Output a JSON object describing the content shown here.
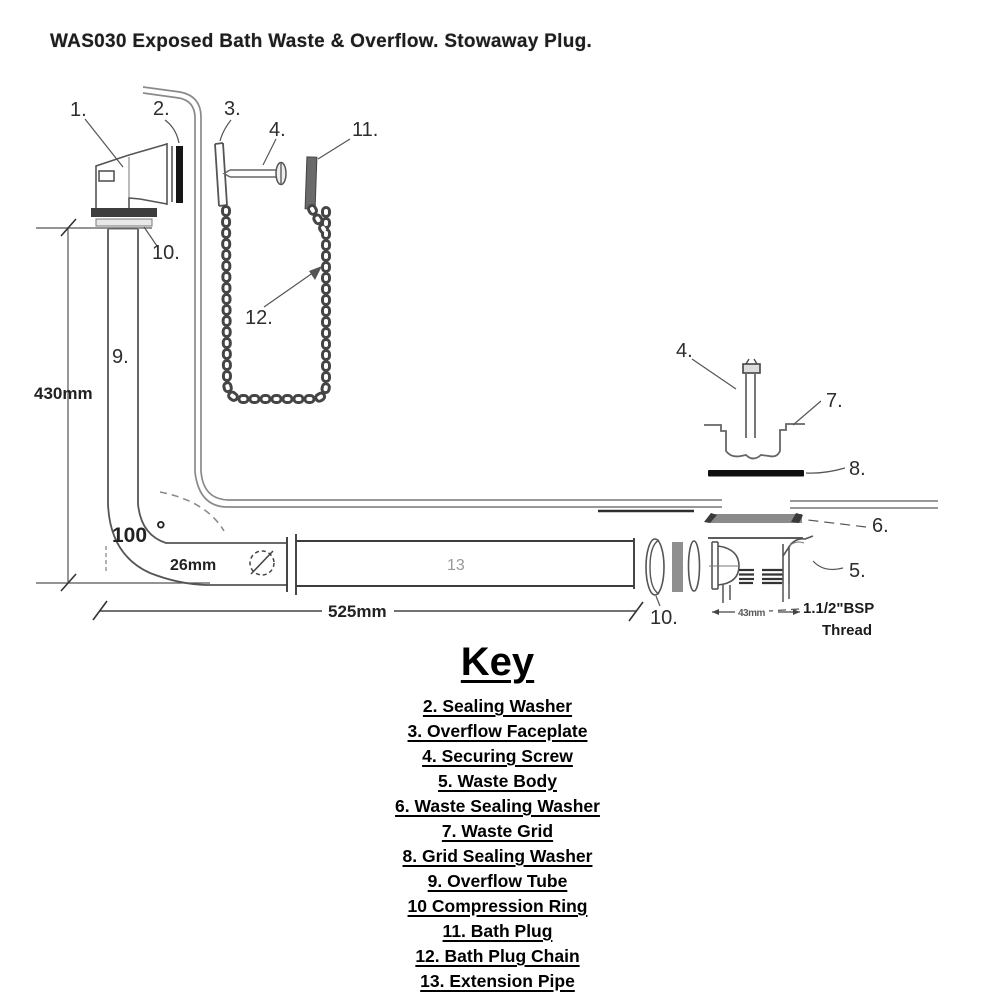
{
  "title": "WAS030 Exposed Bath Waste & Overflow. Stowaway Plug.",
  "diagram": {
    "callouts": {
      "overflow_body": "1.",
      "sealing_washer": "2.",
      "overflow_faceplate": "3.",
      "securing_screw_left": "4.",
      "bath_plug": "11.",
      "compression_ring_left": "10.",
      "bath_plug_chain": "12.",
      "overflow_tube": "9.",
      "securing_screw_right": "4.",
      "waste_grid": "7.",
      "grid_sealing_washer": "8.",
      "waste_sealing_washer": "6.",
      "waste_body": "5.",
      "compression_ring_right": "10.",
      "extension_pipe": "13"
    },
    "dimensions": {
      "overall_height": "430mm",
      "overall_length": "525mm",
      "tube_diameter": "26mm",
      "bend_angle": "100",
      "degree": "°",
      "waste_width": "43mm",
      "thread_line1": "1.1/2\"BSP",
      "thread_line2": "Thread"
    }
  },
  "key": {
    "heading": "Key",
    "items": [
      "2. Sealing Washer",
      "3. Overflow Faceplate",
      "4. Securing Screw",
      "5. Waste Body",
      "6. Waste Sealing Washer",
      "7. Waste Grid",
      "8. Grid Sealing Washer",
      "9. Overflow Tube",
      "10 Compression Ring",
      "11. Bath Plug",
      "12. Bath Plug Chain",
      "13. Extension Pipe"
    ]
  }
}
